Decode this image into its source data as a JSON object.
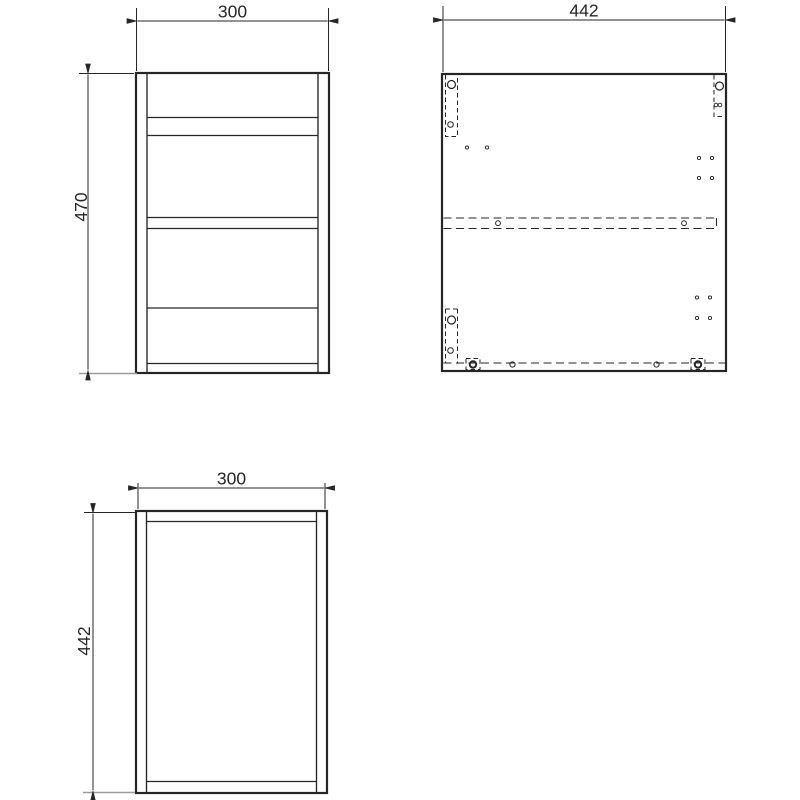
{
  "views": {
    "front": {
      "width": "300",
      "height": "470"
    },
    "side_panel": {
      "width": "442"
    },
    "top": {
      "width": "300",
      "depth": "442"
    }
  },
  "colors": {
    "line": "#262626",
    "ground": "#9c9c9c",
    "background": "#ffffff"
  }
}
